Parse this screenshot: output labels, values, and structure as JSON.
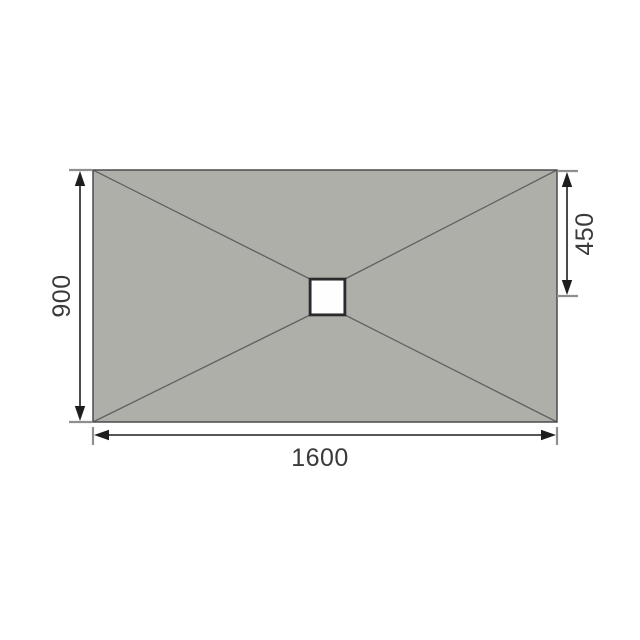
{
  "diagram": {
    "description": "Plan-view technical drawing of a rectangular wetroom shower tray with four diagonal fall lines running from each corner to a central square drain, annotated with dimension lines",
    "dimensions": {
      "width_label": "1600",
      "height_label": "900",
      "drain_offset_label": "450"
    },
    "colors": {
      "background": "#ffffff",
      "tray_fill": "#aeafa9",
      "tray_border": "#4a4b4d",
      "diagonal_line": "#5f6163",
      "drain_fill": "#fefefe",
      "drain_border": "#2a2b2d",
      "dimension_line": "#1e1e1e",
      "extension_tick": "#8e8f91",
      "label_text": "#3a3a3c"
    }
  }
}
